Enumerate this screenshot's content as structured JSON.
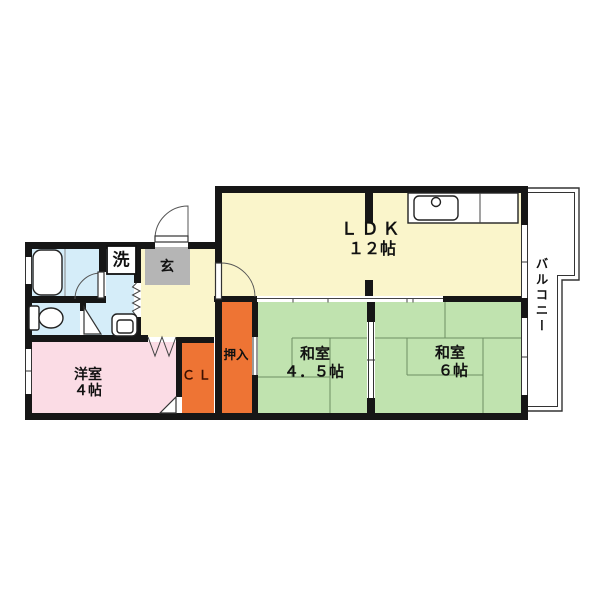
{
  "doc": {
    "type": "floor-plan"
  },
  "rooms": {
    "ldk": {
      "name": "ＬＤＫ",
      "size": "１２帖"
    },
    "washitsu45": {
      "name": "和室",
      "size": "４．５帖"
    },
    "washitsu6": {
      "name": "和室",
      "size": "６帖"
    },
    "yoshitsu": {
      "name": "洋室",
      "size": "４帖"
    },
    "oshiire": {
      "label": "押入"
    },
    "closet": {
      "label": "ＣＬ"
    },
    "genkan": {
      "label": "玄"
    },
    "laundry": {
      "label": "洗"
    },
    "balcony": {
      "label": "バルコニー"
    }
  },
  "colors": {
    "wall": "#161616",
    "yellow": "#faf5cb",
    "green": "#c0e3af",
    "pink": "#fbdce5",
    "orange": "#ee7434",
    "blue": "#d5edf9",
    "gray": "#b5b5b5",
    "tatami-line": "#6e8f63"
  }
}
